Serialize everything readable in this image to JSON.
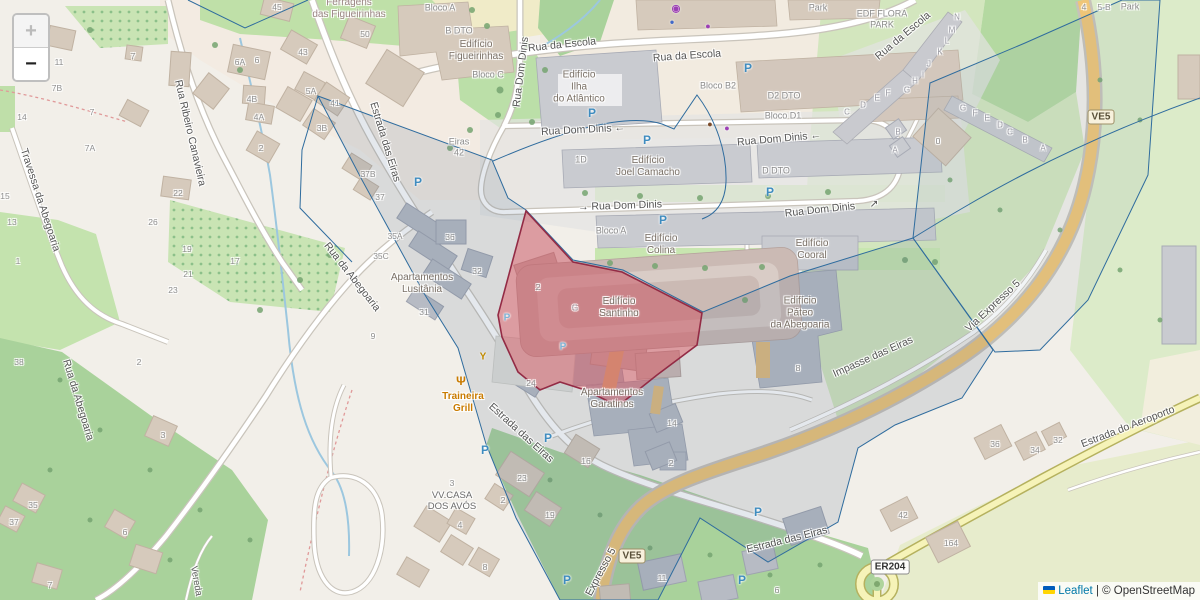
{
  "controls": {
    "zoom_in": "+",
    "zoom_out": "−"
  },
  "attribution": {
    "leaflet": "Leaflet",
    "separator": " | ",
    "copyright": "© OpenStreetMap",
    "flag_icon": "ukraine-flag"
  },
  "colors": {
    "highlight_fill": "rgba(225,80,90,0.45)",
    "highlight_stroke": "#932B45",
    "parcel_stroke": "#2F6C9E",
    "trunk_road": "#EFC577",
    "tertiary_road": "#F6F3B8",
    "parking_blue": "#3F8CBF",
    "poi_orange": "#C97B00",
    "link_blue": "#0078A8"
  },
  "shields": [
    {
      "text": "VE5",
      "x": 1101,
      "y": 117,
      "cls": "tan"
    },
    {
      "text": "VE5",
      "x": 632,
      "y": 556,
      "cls": "tan"
    },
    {
      "text": "ER204",
      "x": 890,
      "y": 567,
      "cls": "white"
    }
  ],
  "parking": [
    {
      "x": 592,
      "y": 113
    },
    {
      "x": 647,
      "y": 140
    },
    {
      "x": 748,
      "y": 68
    },
    {
      "x": 770,
      "y": 192
    },
    {
      "x": 663,
      "y": 220
    },
    {
      "x": 418,
      "y": 182
    },
    {
      "x": 485,
      "y": 450
    },
    {
      "x": 548,
      "y": 438
    },
    {
      "x": 758,
      "y": 512
    },
    {
      "x": 742,
      "y": 580
    },
    {
      "x": 567,
      "y": 580
    },
    {
      "x": 507,
      "y": 318,
      "sm": true
    },
    {
      "x": 563,
      "y": 347,
      "sm": true
    }
  ],
  "pois": [
    {
      "name": "restaurant-icon",
      "glyph": "Ψ",
      "x": 461,
      "y": 381,
      "color": "#C97B00",
      "size": 12
    },
    {
      "name": "bar-icon",
      "glyph": "Y",
      "x": 483,
      "y": 357,
      "color": "#C08A00",
      "size": 10
    },
    {
      "name": "cafe-icon",
      "glyph": "●",
      "x": 710,
      "y": 124,
      "color": "#7B4B2A",
      "size": 9
    },
    {
      "name": "shop-basket-icon",
      "glyph": "●",
      "x": 727,
      "y": 128,
      "color": "#9C3FB5",
      "size": 9
    },
    {
      "name": "bakery-icon",
      "glyph": "●",
      "x": 708,
      "y": 26,
      "color": "#9C3FB5",
      "size": 9
    },
    {
      "name": "casino-icon",
      "glyph": "◉",
      "x": 676,
      "y": 9,
      "color": "#9C3FB5",
      "size": 10
    },
    {
      "name": "marker-icon",
      "glyph": "●",
      "x": 672,
      "y": 22,
      "color": "#4169C8",
      "size": 8
    }
  ],
  "labels": [
    {
      "t": "Rua da Escola",
      "x": 562,
      "y": 45,
      "r": -6,
      "c": "st"
    },
    {
      "t": "Rua da Escola",
      "x": 687,
      "y": 56,
      "r": -4,
      "c": "st"
    },
    {
      "t": "Rua da Escola",
      "x": 903,
      "y": 36,
      "r": -40,
      "c": "st"
    },
    {
      "t": "Rua Dom Dinis",
      "x": 521,
      "y": 72,
      "r": -83,
      "c": "st"
    },
    {
      "t": "Rua Dom Dinis ←",
      "x": 583,
      "y": 130,
      "r": -3,
      "c": "st"
    },
    {
      "t": "Rua Dom Dinis ←",
      "x": 779,
      "y": 139,
      "r": -5,
      "c": "st"
    },
    {
      "t": "→ Rua Dom Dinis",
      "x": 620,
      "y": 206,
      "r": -2,
      "c": "st"
    },
    {
      "t": "Rua Dom Dinis",
      "x": 820,
      "y": 210,
      "r": -6,
      "c": "st"
    },
    {
      "t": "↗",
      "x": 874,
      "y": 204,
      "r": 0,
      "c": "st"
    },
    {
      "t": "Estrada das Eiras",
      "x": 385,
      "y": 142,
      "r": 73,
      "c": "st"
    },
    {
      "t": "Estrada das Eiras",
      "x": 521,
      "y": 433,
      "r": 42,
      "c": "st"
    },
    {
      "t": "Estrada das Eiras",
      "x": 787,
      "y": 540,
      "r": -14,
      "c": "st"
    },
    {
      "t": "Estrada do Aeroporto",
      "x": 1128,
      "y": 427,
      "r": -21,
      "c": "st"
    },
    {
      "t": "Via Expresso 5",
      "x": 993,
      "y": 306,
      "r": -43,
      "c": "st"
    },
    {
      "t": "Expresso 5",
      "x": 601,
      "y": 572,
      "r": -62,
      "c": "st"
    },
    {
      "t": "Impasse das Eiras",
      "x": 873,
      "y": 357,
      "r": -24,
      "c": "st"
    },
    {
      "t": "Rua Ribeiro Canavieira",
      "x": 190,
      "y": 133,
      "r": 77,
      "c": "st"
    },
    {
      "t": "Travessa da Abegoaria",
      "x": 40,
      "y": 200,
      "r": 72,
      "c": "st"
    },
    {
      "t": "Rua da Abegoaria",
      "x": 352,
      "y": 277,
      "r": 52,
      "c": "st"
    },
    {
      "t": "Rua da Abegoaria",
      "x": 78,
      "y": 400,
      "r": 73,
      "c": "st"
    },
    {
      "t": "Vereda",
      "x": 196,
      "y": 581,
      "r": 80,
      "c": "stsm"
    },
    {
      "t": "Ferragens\ndas Figueirinhas",
      "x": 349,
      "y": 9,
      "r": 0,
      "c": "retail"
    },
    {
      "t": "Bloco A",
      "x": 440,
      "y": 8,
      "r": 0,
      "c": "blk"
    },
    {
      "t": "B DTO",
      "x": 459,
      "y": 31,
      "r": 0,
      "c": "blk"
    },
    {
      "t": "Edifício\nFigueirinhas",
      "x": 476,
      "y": 51,
      "r": 0,
      "c": "bld"
    },
    {
      "t": "Bloco C",
      "x": 488,
      "y": 75,
      "r": 0,
      "c": "blk"
    },
    {
      "t": "Edifício\nIlha\ndo Atlântico",
      "x": 579,
      "y": 87,
      "r": 0,
      "c": "bld"
    },
    {
      "t": "Bloco B2",
      "x": 718,
      "y": 86,
      "r": 0,
      "c": "blk"
    },
    {
      "t": "D2 DTO",
      "x": 784,
      "y": 96,
      "r": 0,
      "c": "blk"
    },
    {
      "t": "Bloco D1",
      "x": 783,
      "y": 116,
      "r": 0,
      "c": "blk"
    },
    {
      "t": "1D",
      "x": 581,
      "y": 160,
      "r": 0,
      "c": "blk"
    },
    {
      "t": "Edifício\nJoel Camacho",
      "x": 648,
      "y": 167,
      "r": 0,
      "c": "bld"
    },
    {
      "t": "D DTO",
      "x": 776,
      "y": 171,
      "r": 0,
      "c": "blk"
    },
    {
      "t": "Bloco A",
      "x": 611,
      "y": 231,
      "r": 0,
      "c": "blk"
    },
    {
      "t": "Edifício\nColina",
      "x": 661,
      "y": 245,
      "r": 0,
      "c": "bld"
    },
    {
      "t": "Edifício\nCooral",
      "x": 812,
      "y": 250,
      "r": 0,
      "c": "bld"
    },
    {
      "t": "Edifício\nSantinho",
      "x": 619,
      "y": 308,
      "r": 0,
      "c": "bld"
    },
    {
      "t": "Edifício\nPáteo\nda Abegoaria",
      "x": 800,
      "y": 313,
      "r": 0,
      "c": "bld"
    },
    {
      "t": "Apartamentos\nLusitânia",
      "x": 422,
      "y": 284,
      "r": 0,
      "c": "bld"
    },
    {
      "t": "Apartamentos\nGaratinos",
      "x": 612,
      "y": 399,
      "r": 0,
      "c": "bld"
    },
    {
      "t": "Eiras\n42",
      "x": 459,
      "y": 147,
      "r": 0,
      "c": "blk"
    },
    {
      "t": "EDF FLORA\nPARK",
      "x": 882,
      "y": 19,
      "r": 0,
      "c": "blk"
    },
    {
      "t": "Park",
      "x": 818,
      "y": 8,
      "r": 0,
      "c": "blk"
    },
    {
      "t": "Park",
      "x": 1130,
      "y": 7,
      "r": 0,
      "c": "blk"
    },
    {
      "t": "4",
      "x": 1084,
      "y": 7,
      "r": 0,
      "c": "num"
    },
    {
      "t": "5-B",
      "x": 1104,
      "y": 7,
      "r": 0,
      "c": "num"
    },
    {
      "t": "Traineira\nGrill",
      "x": 463,
      "y": 403,
      "r": 0,
      "c": "poi"
    },
    {
      "t": "VV.CASA\nDOS AVÓS",
      "x": 452,
      "y": 501,
      "r": 0,
      "c": "dk"
    },
    {
      "t": "11",
      "x": 59,
      "y": 62,
      "c": "num"
    },
    {
      "t": "7B",
      "x": 57,
      "y": 88,
      "c": "num"
    },
    {
      "t": "7",
      "x": 133,
      "y": 56,
      "c": "num"
    },
    {
      "t": "14",
      "x": 22,
      "y": 117,
      "c": "num"
    },
    {
      "t": "7",
      "x": 92,
      "y": 112,
      "c": "num"
    },
    {
      "t": "7A",
      "x": 90,
      "y": 148,
      "c": "num"
    },
    {
      "t": "22",
      "x": 178,
      "y": 193,
      "c": "num"
    },
    {
      "t": "45",
      "x": 277,
      "y": 7,
      "c": "num"
    },
    {
      "t": "50",
      "x": 365,
      "y": 34,
      "c": "num"
    },
    {
      "t": "43",
      "x": 303,
      "y": 52,
      "c": "num"
    },
    {
      "t": "6A",
      "x": 240,
      "y": 62,
      "c": "num"
    },
    {
      "t": "6",
      "x": 257,
      "y": 60,
      "c": "num"
    },
    {
      "t": "4B",
      "x": 252,
      "y": 99,
      "c": "num"
    },
    {
      "t": "4A",
      "x": 259,
      "y": 117,
      "c": "num"
    },
    {
      "t": "5A",
      "x": 311,
      "y": 91,
      "c": "num"
    },
    {
      "t": "41",
      "x": 335,
      "y": 103,
      "c": "num"
    },
    {
      "t": "2",
      "x": 261,
      "y": 148,
      "c": "num"
    },
    {
      "t": "3B",
      "x": 322,
      "y": 128,
      "c": "num"
    },
    {
      "t": "37B",
      "x": 368,
      "y": 174,
      "c": "num"
    },
    {
      "t": "37",
      "x": 380,
      "y": 197,
      "c": "num"
    },
    {
      "t": "35A",
      "x": 395,
      "y": 236,
      "c": "num"
    },
    {
      "t": "35C",
      "x": 381,
      "y": 256,
      "c": "num"
    },
    {
      "t": "36",
      "x": 450,
      "y": 237,
      "c": "num"
    },
    {
      "t": "32",
      "x": 477,
      "y": 271,
      "c": "num"
    },
    {
      "t": "31",
      "x": 424,
      "y": 312,
      "c": "num"
    },
    {
      "t": "15",
      "x": 5,
      "y": 196,
      "c": "num"
    },
    {
      "t": "13",
      "x": 12,
      "y": 222,
      "c": "num"
    },
    {
      "t": "1",
      "x": 18,
      "y": 261,
      "c": "num"
    },
    {
      "t": "38",
      "x": 19,
      "y": 362,
      "c": "num"
    },
    {
      "t": "26",
      "x": 153,
      "y": 222,
      "c": "num"
    },
    {
      "t": "19",
      "x": 187,
      "y": 249,
      "c": "num"
    },
    {
      "t": "21",
      "x": 188,
      "y": 274,
      "c": "num"
    },
    {
      "t": "23",
      "x": 173,
      "y": 290,
      "c": "num"
    },
    {
      "t": "17",
      "x": 235,
      "y": 261,
      "c": "num"
    },
    {
      "t": "2",
      "x": 139,
      "y": 362,
      "c": "num"
    },
    {
      "t": "9",
      "x": 373,
      "y": 336,
      "c": "num"
    },
    {
      "t": "2",
      "x": 538,
      "y": 287,
      "c": "num"
    },
    {
      "t": "G",
      "x": 575,
      "y": 308,
      "c": "ltr"
    },
    {
      "t": "24",
      "x": 531,
      "y": 383,
      "c": "num"
    },
    {
      "t": "16",
      "x": 586,
      "y": 461,
      "c": "num"
    },
    {
      "t": "23",
      "x": 522,
      "y": 478,
      "c": "num"
    },
    {
      "t": "2",
      "x": 503,
      "y": 500,
      "c": "num"
    },
    {
      "t": "19",
      "x": 550,
      "y": 515,
      "c": "num"
    },
    {
      "t": "14",
      "x": 672,
      "y": 423,
      "c": "num"
    },
    {
      "t": "2",
      "x": 671,
      "y": 463,
      "c": "num"
    },
    {
      "t": "11",
      "x": 662,
      "y": 578,
      "c": "num"
    },
    {
      "t": "8",
      "x": 485,
      "y": 567,
      "c": "num"
    },
    {
      "t": "4",
      "x": 460,
      "y": 525,
      "c": "num"
    },
    {
      "t": "3",
      "x": 452,
      "y": 483,
      "c": "num"
    },
    {
      "t": "8",
      "x": 798,
      "y": 368,
      "c": "num"
    },
    {
      "t": "36",
      "x": 995,
      "y": 444,
      "c": "num"
    },
    {
      "t": "34",
      "x": 1035,
      "y": 450,
      "c": "num"
    },
    {
      "t": "32",
      "x": 1058,
      "y": 440,
      "c": "num"
    },
    {
      "t": "42",
      "x": 903,
      "y": 515,
      "c": "num"
    },
    {
      "t": "164",
      "x": 951,
      "y": 543,
      "c": "num"
    },
    {
      "t": "35",
      "x": 33,
      "y": 505,
      "c": "num"
    },
    {
      "t": "37",
      "x": 14,
      "y": 522,
      "c": "num"
    },
    {
      "t": "3",
      "x": 163,
      "y": 435,
      "c": "num"
    },
    {
      "t": "6",
      "x": 125,
      "y": 532,
      "c": "num"
    },
    {
      "t": "7",
      "x": 50,
      "y": 585,
      "c": "num"
    },
    {
      "t": "6",
      "x": 777,
      "y": 590,
      "c": "num"
    },
    {
      "t": "0",
      "x": 938,
      "y": 141,
      "c": "num"
    },
    {
      "t": "N",
      "x": 957,
      "y": 17,
      "c": "ltr"
    },
    {
      "t": "M",
      "x": 952,
      "y": 30,
      "c": "ltr"
    },
    {
      "t": "L",
      "x": 947,
      "y": 41,
      "c": "ltr"
    },
    {
      "t": "K",
      "x": 940,
      "y": 52,
      "c": "ltr"
    },
    {
      "t": "J",
      "x": 929,
      "y": 64,
      "c": "ltr"
    },
    {
      "t": "I",
      "x": 923,
      "y": 75,
      "c": "ltr"
    },
    {
      "t": "H",
      "x": 915,
      "y": 81,
      "c": "ltr"
    },
    {
      "t": "G",
      "x": 907,
      "y": 90,
      "c": "ltr"
    },
    {
      "t": "F",
      "x": 888,
      "y": 93,
      "c": "ltr"
    },
    {
      "t": "E",
      "x": 877,
      "y": 98,
      "c": "ltr"
    },
    {
      "t": "D",
      "x": 863,
      "y": 105,
      "c": "ltr"
    },
    {
      "t": "C",
      "x": 847,
      "y": 112,
      "c": "ltr"
    },
    {
      "t": "B",
      "x": 898,
      "y": 132,
      "c": "ltr"
    },
    {
      "t": "A",
      "x": 895,
      "y": 150,
      "c": "ltr"
    },
    {
      "t": "G",
      "x": 963,
      "y": 108,
      "c": "ltr"
    },
    {
      "t": "F",
      "x": 975,
      "y": 113,
      "c": "ltr"
    },
    {
      "t": "E",
      "x": 987,
      "y": 118,
      "c": "ltr"
    },
    {
      "t": "D",
      "x": 1000,
      "y": 125,
      "c": "ltr"
    },
    {
      "t": "C",
      "x": 1010,
      "y": 132,
      "c": "ltr"
    },
    {
      "t": "B",
      "x": 1025,
      "y": 140,
      "c": "ltr"
    },
    {
      "t": "A",
      "x": 1043,
      "y": 148,
      "c": "ltr"
    }
  ]
}
